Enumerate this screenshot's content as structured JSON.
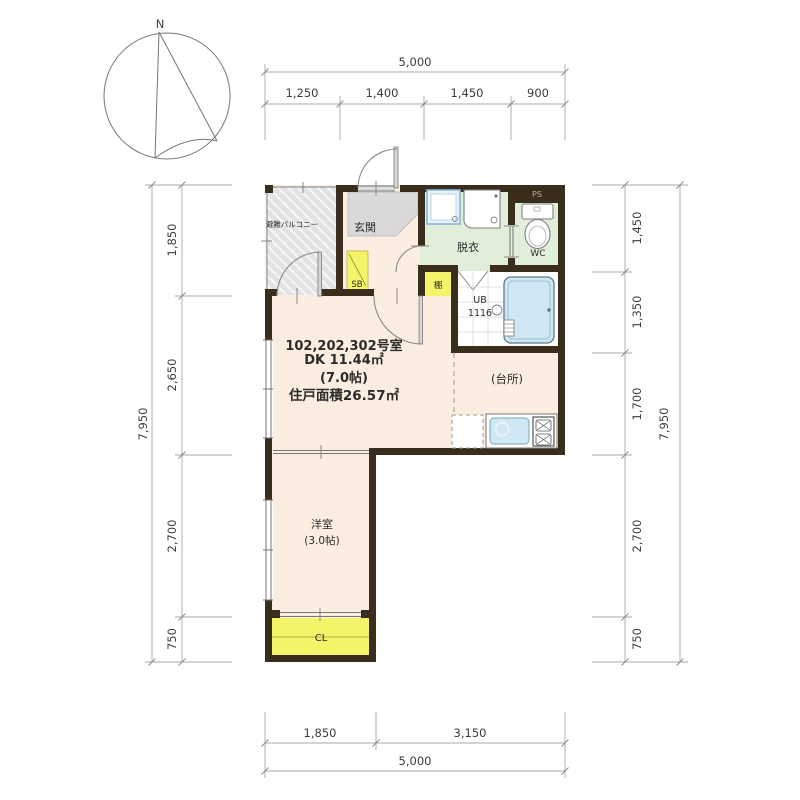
{
  "compass": {
    "north": "N"
  },
  "rooms": {
    "balcony": "避難バルコニー",
    "entrance": "玄関",
    "shoe_box": "SB",
    "dressing_room": "脱衣",
    "toilet": "WC",
    "pipe_space": "PS",
    "shelf": "棚",
    "unit_bath_line1": "UB",
    "unit_bath_line2": "1116",
    "kitchen": "(台所)",
    "western_room": "洋室",
    "western_room_size": "(3.0帖)",
    "closet": "CL"
  },
  "unit_info": {
    "room_numbers": "102,202,302号室",
    "dk_area": "DK 11.44㎡",
    "dk_tatami": "(7.0帖)",
    "total_area": "住戸面積26.57㎡"
  },
  "dimensions": {
    "top": {
      "total": "5,000",
      "segments": [
        "1,250",
        "1,400",
        "1,450",
        "900"
      ]
    },
    "bottom": {
      "total": "5,000",
      "segments": [
        "1,850",
        "3,150"
      ]
    },
    "left": {
      "total": "7,950",
      "segments": [
        "1,850",
        "2,650",
        "2,700",
        "750"
      ]
    },
    "right": {
      "total": "7,950",
      "segments": [
        "1,450",
        "1,350",
        "1,700",
        "2,700",
        "750"
      ]
    }
  },
  "colors": {
    "wall": "#3a2d1d",
    "floor": "#fbeee0",
    "wet_area_green": "#e0eeda",
    "accent_yellow": "#f3f468",
    "bath_blue": "#cfe7f2",
    "balcony_gray": "#e3e3e6",
    "tile_gray": "#d9d9d9"
  }
}
